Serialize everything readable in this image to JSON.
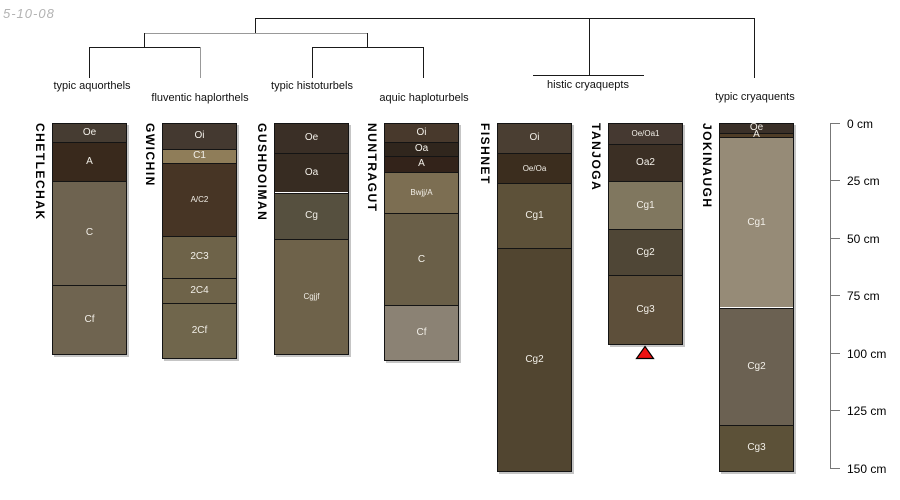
{
  "figure": {
    "date_label": "5-10-08"
  },
  "dendrogram": {
    "line_color": "#1a1a1a",
    "alt_line_color": "#999999",
    "leaf_labels": [
      "typic aquorthels",
      "fluventic haplorthels",
      "typic histoturbels",
      "aquic haploturbels",
      "histic cryaquepts",
      "typic cryaquents"
    ]
  },
  "depth_scale": {
    "unit": "cm",
    "tick_labels": [
      "0 cm",
      "25 cm",
      "50 cm",
      "75 cm",
      "100 cm",
      "125 cm",
      "150 cm"
    ],
    "tick_values_cm": [
      0,
      25,
      50,
      75,
      100,
      125,
      150
    ]
  },
  "marker": {
    "shape": "triangle",
    "color": "#ee1111",
    "outline": "#000000",
    "below_column": "TANJOGA"
  },
  "chart_data": {
    "type": "bar",
    "subtype": "stacked soil-horizon depth columns grouped by dendrogram",
    "title": "",
    "xlabel": "",
    "ylabel": "depth (cm)",
    "ylim": [
      0,
      150
    ],
    "yticks": [
      0,
      25,
      50,
      75,
      100,
      125,
      150
    ],
    "columns": [
      {
        "name": "CHETLECHAK",
        "taxon": "typic aquorthels",
        "horizons": [
          {
            "label": "Oe",
            "top_cm": 0,
            "bottom_cm": 8,
            "color": "#463c32",
            "small": false
          },
          {
            "label": "A",
            "top_cm": 8,
            "bottom_cm": 25,
            "color": "#39291c",
            "small": false
          },
          {
            "label": "C",
            "top_cm": 25,
            "bottom_cm": 70,
            "color": "#6e6350",
            "small": false
          },
          {
            "label": "Cf",
            "top_cm": 70,
            "bottom_cm": 100,
            "color": "#6f6450",
            "small": false
          }
        ]
      },
      {
        "name": "GWICHIN",
        "taxon": "fluventic haplorthels",
        "horizons": [
          {
            "label": "Oi",
            "top_cm": 0,
            "bottom_cm": 11,
            "color": "#443930",
            "small": false
          },
          {
            "label": "C1",
            "top_cm": 11,
            "bottom_cm": 17,
            "color": "#8f7d59",
            "small": false
          },
          {
            "label": "A/C2",
            "top_cm": 17,
            "bottom_cm": 49,
            "color": "#473525",
            "small": true
          },
          {
            "label": "2C3",
            "top_cm": 49,
            "bottom_cm": 67,
            "color": "#6e6349",
            "small": false
          },
          {
            "label": "2C4",
            "top_cm": 67,
            "bottom_cm": 78,
            "color": "#6e6349",
            "small": false
          },
          {
            "label": "2Cf",
            "top_cm": 78,
            "bottom_cm": 102,
            "color": "#70664c",
            "small": false
          }
        ]
      },
      {
        "name": "GUSHDOIMAN",
        "taxon": "typic histoturbels",
        "horizons": [
          {
            "label": "Oe",
            "top_cm": 0,
            "bottom_cm": 13,
            "color": "#3a2f26",
            "small": false
          },
          {
            "label": "Oa",
            "top_cm": 13,
            "bottom_cm": 30,
            "color": "#372c22",
            "small": false
          },
          {
            "label": "Cg",
            "top_cm": 30,
            "bottom_cm": 50,
            "color": "#56503f",
            "small": false
          },
          {
            "label": "Cgjjf",
            "top_cm": 50,
            "bottom_cm": 100,
            "color": "#6e624a",
            "small": true
          }
        ]
      },
      {
        "name": "NUNTRAGUT",
        "taxon": "aquic haploturbels",
        "horizons": [
          {
            "label": "Oi",
            "top_cm": 0,
            "bottom_cm": 8,
            "color": "#48392c",
            "small": false
          },
          {
            "label": "Oa",
            "top_cm": 8,
            "bottom_cm": 14,
            "color": "#30261d",
            "small": false
          },
          {
            "label": "A",
            "top_cm": 14,
            "bottom_cm": 21,
            "color": "#33231a",
            "small": false
          },
          {
            "label": "Bwjj/A",
            "top_cm": 21,
            "bottom_cm": 39,
            "color": "#7c6e52",
            "small": true
          },
          {
            "label": "C",
            "top_cm": 39,
            "bottom_cm": 79,
            "color": "#6a5f48",
            "small": false
          },
          {
            "label": "Cf",
            "top_cm": 79,
            "bottom_cm": 103,
            "color": "#8b8274",
            "small": false
          }
        ]
      },
      {
        "name": "FISHNET",
        "taxon": "histic cryaquepts",
        "horizons": [
          {
            "label": "Oi",
            "top_cm": 0,
            "bottom_cm": 13,
            "color": "#4a3e32",
            "small": false
          },
          {
            "label": "Oe/Oa",
            "top_cm": 13,
            "bottom_cm": 26,
            "color": "#3b2d1e",
            "small": true
          },
          {
            "label": "Cg1",
            "top_cm": 26,
            "bottom_cm": 54,
            "color": "#5d5139",
            "small": false
          },
          {
            "label": "Cg2",
            "top_cm": 54,
            "bottom_cm": 151,
            "color": "#514530",
            "small": false
          }
        ]
      },
      {
        "name": "TANJOGA",
        "taxon": "histic cryaquepts",
        "marker": true,
        "horizons": [
          {
            "label": "Oe/Oa1",
            "top_cm": 0,
            "bottom_cm": 9,
            "color": "#453931",
            "small": true
          },
          {
            "label": "Oa2",
            "top_cm": 9,
            "bottom_cm": 25,
            "color": "#3b2f24",
            "small": false
          },
          {
            "label": "Cg1",
            "top_cm": 25,
            "bottom_cm": 46,
            "color": "#80775f",
            "small": false
          },
          {
            "label": "Cg2",
            "top_cm": 46,
            "bottom_cm": 66,
            "color": "#4f4636",
            "small": false
          },
          {
            "label": "Cg3",
            "top_cm": 66,
            "bottom_cm": 96,
            "color": "#5d4f3a",
            "small": false
          }
        ]
      },
      {
        "name": "JOKINAUGH",
        "taxon": "typic cryaquents",
        "horizons": [
          {
            "label": "Oe",
            "top_cm": 0,
            "bottom_cm": 4,
            "color": "#3a3028",
            "small": false
          },
          {
            "label": "A",
            "top_cm": 4,
            "bottom_cm": 6,
            "color": "#4f3d27",
            "small": false
          },
          {
            "label": "Cg1",
            "top_cm": 6,
            "bottom_cm": 80,
            "color": "#968b77",
            "small": false
          },
          {
            "label": "Cg2",
            "top_cm": 80,
            "bottom_cm": 131,
            "color": "#6b6152",
            "small": false
          },
          {
            "label": "Cg3",
            "top_cm": 131,
            "bottom_cm": 151,
            "color": "#5c5138",
            "small": false
          }
        ]
      }
    ]
  }
}
